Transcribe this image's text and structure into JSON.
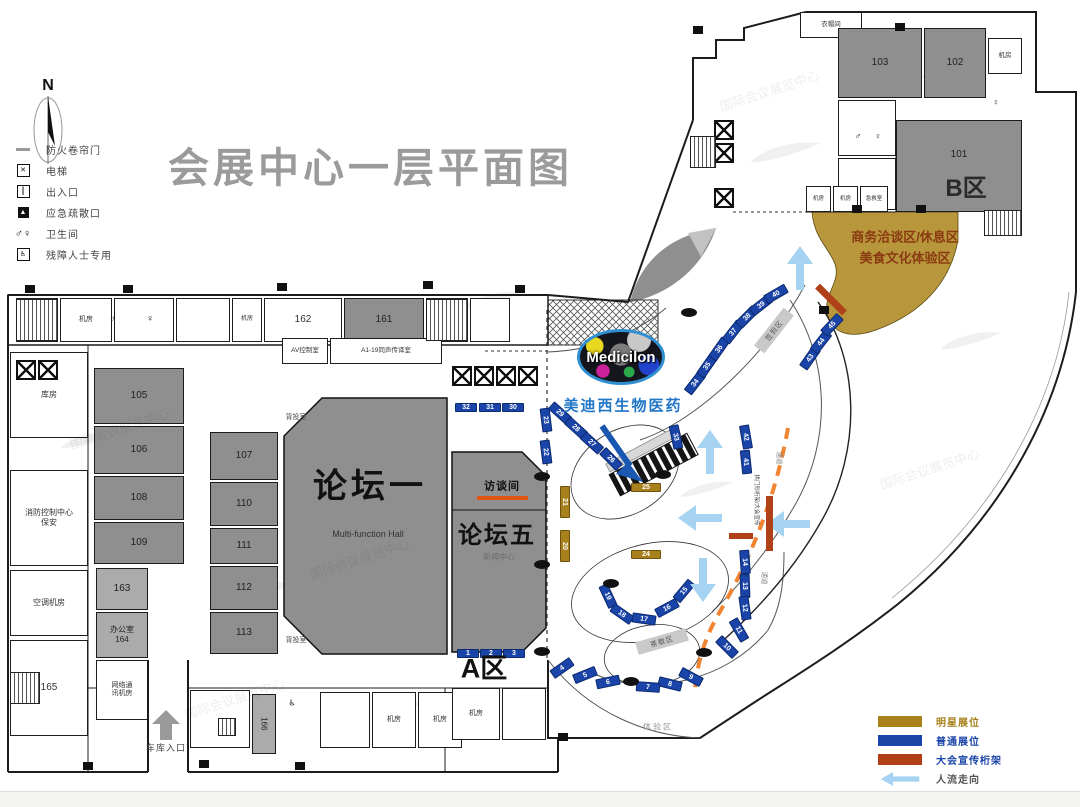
{
  "title": "会展中心一层平面图",
  "compass": "N",
  "legend_top": [
    {
      "style": "line",
      "sym": "",
      "label": "防火卷帘门"
    },
    {
      "style": "box",
      "sym": "✕",
      "label": "电梯"
    },
    {
      "style": "box",
      "sym": "║",
      "label": "出入口"
    },
    {
      "style": "boxinv",
      "sym": "▲",
      "label": "应急疏散口"
    },
    {
      "style": "plain",
      "sym": "♂♀",
      "label": "卫生间"
    },
    {
      "style": "box",
      "sym": "♿",
      "label": "残障人士专用"
    }
  ],
  "legend_bottom": [
    {
      "c": "#a8801c",
      "lc": "#a8801c",
      "label": "明星展位",
      "arrow": false
    },
    {
      "c": "#1a44a8",
      "lc": "#1a44a8",
      "label": "普通展位",
      "arrow": false
    },
    {
      "c": "#b04018",
      "lc": "#1a44a8",
      "label": "大会宣传桁架",
      "arrow": false
    },
    {
      "c": "",
      "lc": "#555555",
      "label": "人流走向",
      "arrow": true
    }
  ],
  "medicilon": {
    "logo": "Medicilon",
    "caption": "美迪西生物医药"
  },
  "zones": {
    "a": "A区",
    "b": "B区",
    "biz1": "商务洽谈区/休息区",
    "biz2": "美食文化体验区"
  },
  "halls": {
    "forum1": "论坛一",
    "forum1_sub": "Multi-function Hall",
    "forum5": "论坛五",
    "interview": "访谈间"
  },
  "rooms": [
    {
      "x": 16,
      "y": 298,
      "w": 42,
      "h": 44,
      "f": "w",
      "t": "",
      "fs": 7
    },
    {
      "x": 60,
      "y": 298,
      "w": 52,
      "h": 44,
      "f": "w",
      "t": "机房",
      "fs": 7
    },
    {
      "x": 114,
      "y": 298,
      "w": 60,
      "h": 44,
      "f": "w",
      "t": "",
      "fs": 7
    },
    {
      "x": 176,
      "y": 298,
      "w": 54,
      "h": 44,
      "f": "w",
      "t": "",
      "fs": 7
    },
    {
      "x": 232,
      "y": 298,
      "w": 30,
      "h": 44,
      "f": "w",
      "t": "机房",
      "fs": 6
    },
    {
      "x": 264,
      "y": 298,
      "w": 78,
      "h": 44,
      "f": "w",
      "t": "162",
      "fs": 10
    },
    {
      "x": 344,
      "y": 298,
      "w": 80,
      "h": 44,
      "f": "g",
      "t": "161",
      "fs": 10
    },
    {
      "x": 426,
      "y": 298,
      "w": 42,
      "h": 44,
      "f": "w",
      "t": "",
      "fs": 7
    },
    {
      "x": 470,
      "y": 298,
      "w": 40,
      "h": 44,
      "f": "w",
      "t": "",
      "fs": 7
    },
    {
      "x": 10,
      "y": 352,
      "w": 78,
      "h": 86,
      "f": "w",
      "t": "库房",
      "fs": 8
    },
    {
      "x": 10,
      "y": 470,
      "w": 78,
      "h": 96,
      "f": "w",
      "t": "消防控制中心\n保安",
      "fs": 8
    },
    {
      "x": 10,
      "y": 570,
      "w": 78,
      "h": 66,
      "f": "w",
      "t": "空调机房",
      "fs": 8
    },
    {
      "x": 10,
      "y": 640,
      "w": 78,
      "h": 96,
      "f": "w",
      "t": "165",
      "fs": 10
    },
    {
      "x": 94,
      "y": 368,
      "w": 90,
      "h": 56,
      "f": "g",
      "t": "105",
      "fs": 10
    },
    {
      "x": 94,
      "y": 426,
      "w": 90,
      "h": 48,
      "f": "g",
      "t": "106",
      "fs": 10
    },
    {
      "x": 94,
      "y": 476,
      "w": 90,
      "h": 44,
      "f": "g",
      "t": "108",
      "fs": 10
    },
    {
      "x": 94,
      "y": 522,
      "w": 90,
      "h": 42,
      "f": "g",
      "t": "109",
      "fs": 10
    },
    {
      "x": 96,
      "y": 568,
      "w": 52,
      "h": 42,
      "f": "lg",
      "t": "163",
      "fs": 10
    },
    {
      "x": 96,
      "y": 612,
      "w": 52,
      "h": 46,
      "f": "lg",
      "t": "办公室\n164",
      "fs": 8
    },
    {
      "x": 96,
      "y": 660,
      "w": 52,
      "h": 60,
      "f": "w",
      "t": "网络通\n讯机房",
      "fs": 7
    },
    {
      "x": 210,
      "y": 432,
      "w": 68,
      "h": 48,
      "f": "g",
      "t": "107",
      "fs": 10
    },
    {
      "x": 210,
      "y": 482,
      "w": 68,
      "h": 44,
      "f": "g",
      "t": "110",
      "fs": 10
    },
    {
      "x": 210,
      "y": 528,
      "w": 68,
      "h": 36,
      "f": "g",
      "t": "111",
      "fs": 10
    },
    {
      "x": 210,
      "y": 566,
      "w": 68,
      "h": 44,
      "f": "g",
      "t": "112",
      "fs": 10
    },
    {
      "x": 210,
      "y": 612,
      "w": 68,
      "h": 42,
      "f": "g",
      "t": "113",
      "fs": 10
    },
    {
      "x": 282,
      "y": 338,
      "w": 46,
      "h": 26,
      "f": "w",
      "t": "AV控制室",
      "fs": 6.5
    },
    {
      "x": 330,
      "y": 338,
      "w": 112,
      "h": 26,
      "f": "w",
      "t": "A1-19同声传译室",
      "fs": 6.5
    },
    {
      "x": 190,
      "y": 690,
      "w": 60,
      "h": 58,
      "f": "w",
      "t": "",
      "fs": 7
    },
    {
      "x": 252,
      "y": 694,
      "w": 24,
      "h": 60,
      "f": "lg",
      "t": "166",
      "fs": 8,
      "lr": 90
    },
    {
      "x": 320,
      "y": 692,
      "w": 50,
      "h": 56,
      "f": "w",
      "t": "",
      "fs": 7
    },
    {
      "x": 372,
      "y": 692,
      "w": 44,
      "h": 56,
      "f": "w",
      "t": "机房",
      "fs": 7
    },
    {
      "x": 418,
      "y": 692,
      "w": 44,
      "h": 56,
      "f": "w",
      "t": "机房",
      "fs": 7
    },
    {
      "x": 452,
      "y": 688,
      "w": 48,
      "h": 52,
      "f": "w",
      "t": "机房",
      "fs": 7
    },
    {
      "x": 502,
      "y": 688,
      "w": 44,
      "h": 52,
      "f": "w",
      "t": "",
      "fs": 7
    },
    {
      "x": 800,
      "y": 12,
      "w": 62,
      "h": 26,
      "f": "w",
      "t": "衣帽间",
      "fs": 6.5
    },
    {
      "x": 838,
      "y": 28,
      "w": 84,
      "h": 70,
      "f": "g",
      "t": "103",
      "fs": 10
    },
    {
      "x": 924,
      "y": 28,
      "w": 62,
      "h": 70,
      "f": "g",
      "t": "102",
      "fs": 10
    },
    {
      "x": 988,
      "y": 38,
      "w": 34,
      "h": 36,
      "f": "w",
      "t": "机房",
      "fs": 6.5
    },
    {
      "x": 838,
      "y": 100,
      "w": 58,
      "h": 56,
      "f": "w",
      "t": "",
      "fs": 7
    },
    {
      "x": 838,
      "y": 158,
      "w": 58,
      "h": 52,
      "f": "w",
      "t": "",
      "fs": 7
    },
    {
      "x": 896,
      "y": 120,
      "w": 126,
      "h": 92,
      "f": "g",
      "t": "101",
      "fs": 10,
      "lp": "top"
    },
    {
      "x": 806,
      "y": 186,
      "w": 25,
      "h": 26,
      "f": "w",
      "t": "机房",
      "fs": 5.5
    },
    {
      "x": 833,
      "y": 186,
      "w": 25,
      "h": 26,
      "f": "w",
      "t": "机房",
      "fs": 5.5
    },
    {
      "x": 860,
      "y": 186,
      "w": 28,
      "h": 26,
      "f": "w",
      "t": "急救室",
      "fs": 5.5
    }
  ],
  "booths": [
    {
      "n": "32",
      "x": 466,
      "y": 407,
      "r": 0,
      "w": 22,
      "h": 9,
      "c": "b"
    },
    {
      "n": "31",
      "x": 490,
      "y": 407,
      "r": 0,
      "w": 22,
      "h": 9,
      "c": "b"
    },
    {
      "n": "30",
      "x": 513,
      "y": 407,
      "r": 0,
      "w": 22,
      "h": 9,
      "c": "b"
    },
    {
      "n": "23",
      "x": 546,
      "y": 420,
      "r": 83,
      "w": 24,
      "h": 10,
      "c": "b"
    },
    {
      "n": "22",
      "x": 546,
      "y": 452,
      "r": 83,
      "w": 24,
      "h": 10,
      "c": "b"
    },
    {
      "n": "29",
      "x": 560,
      "y": 413,
      "r": 42,
      "w": 24,
      "h": 10,
      "c": "b"
    },
    {
      "n": "28",
      "x": 576,
      "y": 428,
      "r": 42,
      "w": 24,
      "h": 10,
      "c": "b"
    },
    {
      "n": "27",
      "x": 592,
      "y": 443,
      "r": 42,
      "w": 24,
      "h": 10,
      "c": "b"
    },
    {
      "n": "26",
      "x": 611,
      "y": 459,
      "r": 45,
      "w": 24,
      "h": 10,
      "c": "b"
    },
    {
      "n": "33",
      "x": 676,
      "y": 437,
      "r": 78,
      "w": 24,
      "h": 10,
      "c": "b"
    },
    {
      "n": "34",
      "x": 695,
      "y": 383,
      "r": -52,
      "w": 24,
      "h": 10,
      "c": "b"
    },
    {
      "n": "35",
      "x": 707,
      "y": 366,
      "r": -55,
      "w": 24,
      "h": 10,
      "c": "b"
    },
    {
      "n": "36",
      "x": 719,
      "y": 349,
      "r": -55,
      "w": 24,
      "h": 10,
      "c": "b"
    },
    {
      "n": "37",
      "x": 733,
      "y": 332,
      "r": -52,
      "w": 24,
      "h": 10,
      "c": "b"
    },
    {
      "n": "38",
      "x": 747,
      "y": 317,
      "r": -45,
      "w": 24,
      "h": 10,
      "c": "b"
    },
    {
      "n": "39",
      "x": 761,
      "y": 305,
      "r": -38,
      "w": 24,
      "h": 10,
      "c": "b"
    },
    {
      "n": "40",
      "x": 776,
      "y": 294,
      "r": -30,
      "w": 24,
      "h": 10,
      "c": "b"
    },
    {
      "n": "43",
      "x": 810,
      "y": 358,
      "r": -55,
      "w": 24,
      "h": 10,
      "c": "b"
    },
    {
      "n": "44",
      "x": 821,
      "y": 342,
      "r": -52,
      "w": 24,
      "h": 10,
      "c": "b"
    },
    {
      "n": "45",
      "x": 832,
      "y": 325,
      "r": -46,
      "w": 24,
      "h": 10,
      "c": "b"
    },
    {
      "n": "42",
      "x": 746,
      "y": 437,
      "r": 80,
      "w": 24,
      "h": 10,
      "c": "b"
    },
    {
      "n": "41",
      "x": 746,
      "y": 462,
      "r": 84,
      "w": 24,
      "h": 10,
      "c": "b"
    },
    {
      "n": "14",
      "x": 745,
      "y": 562,
      "r": 86,
      "w": 24,
      "h": 10,
      "c": "b"
    },
    {
      "n": "13",
      "x": 745,
      "y": 586,
      "r": 88,
      "w": 24,
      "h": 10,
      "c": "b"
    },
    {
      "n": "12",
      "x": 745,
      "y": 608,
      "r": 82,
      "w": 24,
      "h": 10,
      "c": "b"
    },
    {
      "n": "11",
      "x": 739,
      "y": 630,
      "r": 60,
      "w": 24,
      "h": 10,
      "c": "b"
    },
    {
      "n": "10",
      "x": 727,
      "y": 647,
      "r": 45,
      "w": 24,
      "h": 10,
      "c": "b"
    },
    {
      "n": "9",
      "x": 691,
      "y": 677,
      "r": 28,
      "w": 24,
      "h": 10,
      "c": "b"
    },
    {
      "n": "8",
      "x": 670,
      "y": 684,
      "r": 14,
      "w": 24,
      "h": 10,
      "c": "b"
    },
    {
      "n": "7",
      "x": 648,
      "y": 687,
      "r": 4,
      "w": 24,
      "h": 10,
      "c": "b"
    },
    {
      "n": "6",
      "x": 608,
      "y": 682,
      "r": -12,
      "w": 24,
      "h": 10,
      "c": "b"
    },
    {
      "n": "5",
      "x": 585,
      "y": 675,
      "r": -22,
      "w": 24,
      "h": 10,
      "c": "b"
    },
    {
      "n": "4",
      "x": 562,
      "y": 668,
      "r": -35,
      "w": 24,
      "h": 10,
      "c": "b"
    },
    {
      "n": "19",
      "x": 608,
      "y": 596,
      "r": 65,
      "w": 24,
      "h": 10,
      "c": "b"
    },
    {
      "n": "18",
      "x": 622,
      "y": 614,
      "r": 35,
      "w": 24,
      "h": 10,
      "c": "b"
    },
    {
      "n": "17",
      "x": 644,
      "y": 619,
      "r": 8,
      "w": 24,
      "h": 10,
      "c": "b"
    },
    {
      "n": "16",
      "x": 667,
      "y": 608,
      "r": -28,
      "w": 24,
      "h": 10,
      "c": "b"
    },
    {
      "n": "15",
      "x": 684,
      "y": 591,
      "r": -50,
      "w": 24,
      "h": 10,
      "c": "b"
    },
    {
      "n": "1",
      "x": 468,
      "y": 653,
      "r": 0,
      "w": 22,
      "h": 9,
      "c": "b"
    },
    {
      "n": "2",
      "x": 491,
      "y": 653,
      "r": 0,
      "w": 22,
      "h": 9,
      "c": "b"
    },
    {
      "n": "3",
      "x": 514,
      "y": 653,
      "r": 0,
      "w": 22,
      "h": 9,
      "c": "b"
    },
    {
      "n": "21",
      "x": 565,
      "y": 502,
      "r": 90,
      "w": 32,
      "h": 10,
      "c": "t"
    },
    {
      "n": "20",
      "x": 565,
      "y": 546,
      "r": 90,
      "w": 32,
      "h": 10,
      "c": "t"
    },
    {
      "n": "25",
      "x": 646,
      "y": 487,
      "r": 0,
      "w": 30,
      "h": 9,
      "c": "t"
    },
    {
      "n": "24",
      "x": 646,
      "y": 554,
      "r": 0,
      "w": 30,
      "h": 9,
      "c": "t"
    }
  ],
  "texts": [
    {
      "x": 370,
      "y": 487,
      "t": "论坛一",
      "fs": 34,
      "b": 1,
      "c": "#111",
      "ls": 4
    },
    {
      "x": 368,
      "y": 534,
      "t": "Multi-function Hall",
      "fs": 9,
      "c": "#333"
    },
    {
      "x": 497,
      "y": 536,
      "t": "论坛五",
      "fs": 24,
      "b": 1,
      "c": "#111",
      "ls": 2
    },
    {
      "x": 499,
      "y": 557,
      "t": "新闻中心",
      "fs": 8,
      "c": "rgba(0,0,0,0.25)"
    },
    {
      "x": 502,
      "y": 487,
      "t": "访谈间",
      "fs": 11,
      "b": 1,
      "c": "#111",
      "ls": 1
    },
    {
      "x": 484,
      "y": 669,
      "t": "A区",
      "fs": 27,
      "b": 1,
      "c": "#111"
    },
    {
      "x": 966,
      "y": 189,
      "t": "B区",
      "fs": 24,
      "b": 1,
      "c": "#2a2a2a"
    },
    {
      "x": 905,
      "y": 238,
      "t": "商务洽谈区/休息区",
      "fs": 13,
      "b": 1,
      "c": "#8a3a10"
    },
    {
      "x": 905,
      "y": 259,
      "t": "美食文化体验区",
      "fs": 13,
      "b": 1,
      "c": "#8a3a10"
    },
    {
      "x": 623,
      "y": 406,
      "t": "美迪西生物医药",
      "fs": 15,
      "b": 1,
      "c": "#2176c7",
      "ls": 2
    },
    {
      "x": 296,
      "y": 418,
      "t": "背投室",
      "fs": 7,
      "c": "#444"
    },
    {
      "x": 296,
      "y": 641,
      "t": "背投室",
      "fs": 7,
      "c": "#444"
    },
    {
      "x": 658,
      "y": 727,
      "t": "体验区",
      "fs": 8,
      "c": "#999",
      "ls": 2
    },
    {
      "x": 166,
      "y": 748,
      "t": "车库入口",
      "fs": 9,
      "c": "#444",
      "ls": 1
    },
    {
      "x": 779,
      "y": 458,
      "t": "通道",
      "fs": 6.5,
      "c": "#888",
      "rot": 90
    },
    {
      "x": 764,
      "y": 578,
      "t": "通道",
      "fs": 6.5,
      "c": "#888",
      "rot": 90
    },
    {
      "x": 756,
      "y": 500,
      "t": "拱门形桁架/大会宣传",
      "fs": 5.5,
      "c": "#444",
      "rot": 90
    },
    {
      "x": 113,
      "y": 319,
      "t": "♂",
      "fs": 10,
      "c": "#111"
    },
    {
      "x": 150,
      "y": 319,
      "t": "♀",
      "fs": 10,
      "c": "#111"
    },
    {
      "x": 858,
      "y": 136,
      "t": "♂",
      "fs": 9,
      "c": "#111"
    },
    {
      "x": 878,
      "y": 136,
      "t": "♀",
      "fs": 9,
      "c": "#111"
    },
    {
      "x": 292,
      "y": 703,
      "t": "♿",
      "fs": 8,
      "c": "#111"
    },
    {
      "x": 996,
      "y": 102,
      "t": "♀",
      "fs": 9,
      "c": "#111"
    },
    {
      "x": 961,
      "y": 165,
      "t": "",
      "fs": 8,
      "c": "#333"
    },
    {
      "x": 120,
      "y": 430,
      "t": "国际会议展览中心",
      "fs": 13,
      "c": "rgba(0,0,0,0.07)",
      "rot": -18
    },
    {
      "x": 360,
      "y": 560,
      "t": "国际会议展览中心",
      "fs": 13,
      "c": "rgba(0,0,0,0.07)",
      "rot": -18
    },
    {
      "x": 770,
      "y": 92,
      "t": "国际会议展览中心",
      "fs": 13,
      "c": "rgba(0,0,0,0.07)",
      "rot": -18
    },
    {
      "x": 930,
      "y": 470,
      "t": "国际会议展览中心",
      "fs": 13,
      "c": "rgba(0,0,0,0.07)",
      "rot": -18
    },
    {
      "x": 235,
      "y": 700,
      "t": "国际会议展览中心",
      "fs": 13,
      "c": "rgba(0,0,0,0.07)",
      "rot": -18
    }
  ],
  "tags": [
    {
      "x": 774,
      "y": 330,
      "t": "签到区",
      "r": -52,
      "w": 48,
      "h": 13
    },
    {
      "x": 662,
      "y": 641,
      "t": "茶歇区",
      "r": -16,
      "w": 52,
      "h": 13
    }
  ],
  "pillars": [
    {
      "x": 542,
      "y": 476
    },
    {
      "x": 542,
      "y": 564
    },
    {
      "x": 542,
      "y": 651
    },
    {
      "x": 631,
      "y": 681
    },
    {
      "x": 704,
      "y": 652
    },
    {
      "x": 689,
      "y": 312
    },
    {
      "x": 611,
      "y": 583
    },
    {
      "x": 663,
      "y": 474
    }
  ],
  "exits": [
    {
      "x": 30,
      "y": 289
    },
    {
      "x": 128,
      "y": 289
    },
    {
      "x": 282,
      "y": 287
    },
    {
      "x": 428,
      "y": 285
    },
    {
      "x": 520,
      "y": 289
    },
    {
      "x": 698,
      "y": 30
    },
    {
      "x": 900,
      "y": 27
    },
    {
      "x": 857,
      "y": 209
    },
    {
      "x": 921,
      "y": 209
    },
    {
      "x": 824,
      "y": 310
    },
    {
      "x": 563,
      "y": 737
    },
    {
      "x": 300,
      "y": 766
    },
    {
      "x": 204,
      "y": 764
    },
    {
      "x": 88,
      "y": 766
    }
  ],
  "elevators": [
    {
      "x": 452,
      "y": 366
    },
    {
      "x": 474,
      "y": 366
    },
    {
      "x": 496,
      "y": 366
    },
    {
      "x": 518,
      "y": 366
    },
    {
      "x": 714,
      "y": 120
    },
    {
      "x": 714,
      "y": 143
    },
    {
      "x": 714,
      "y": 188
    },
    {
      "x": 16,
      "y": 360
    },
    {
      "x": 38,
      "y": 360
    }
  ],
  "stairs": [
    {
      "x": 16,
      "y": 299,
      "w": 42,
      "h": 42
    },
    {
      "x": 426,
      "y": 299,
      "w": 42,
      "h": 42
    },
    {
      "x": 10,
      "y": 672,
      "w": 30,
      "h": 32
    },
    {
      "x": 218,
      "y": 718,
      "w": 18,
      "h": 18
    },
    {
      "x": 690,
      "y": 136,
      "w": 26,
      "h": 32
    },
    {
      "x": 984,
      "y": 210,
      "w": 38,
      "h": 26
    }
  ],
  "arrows": [
    {
      "x": 800,
      "y": 268,
      "r": -90
    },
    {
      "x": 710,
      "y": 452,
      "r": -90
    },
    {
      "x": 700,
      "y": 518,
      "r": 180
    },
    {
      "x": 788,
      "y": 524,
      "r": 180
    },
    {
      "x": 703,
      "y": 580,
      "r": 90
    }
  ],
  "trusses": [
    {
      "x": 831,
      "y": 299,
      "r": 45,
      "w": 38,
      "h": 7
    },
    {
      "x": 769,
      "y": 523,
      "r": 90,
      "w": 55,
      "h": 7
    },
    {
      "x": 741,
      "y": 536,
      "r": 0,
      "w": 24,
      "h": 6
    }
  ]
}
